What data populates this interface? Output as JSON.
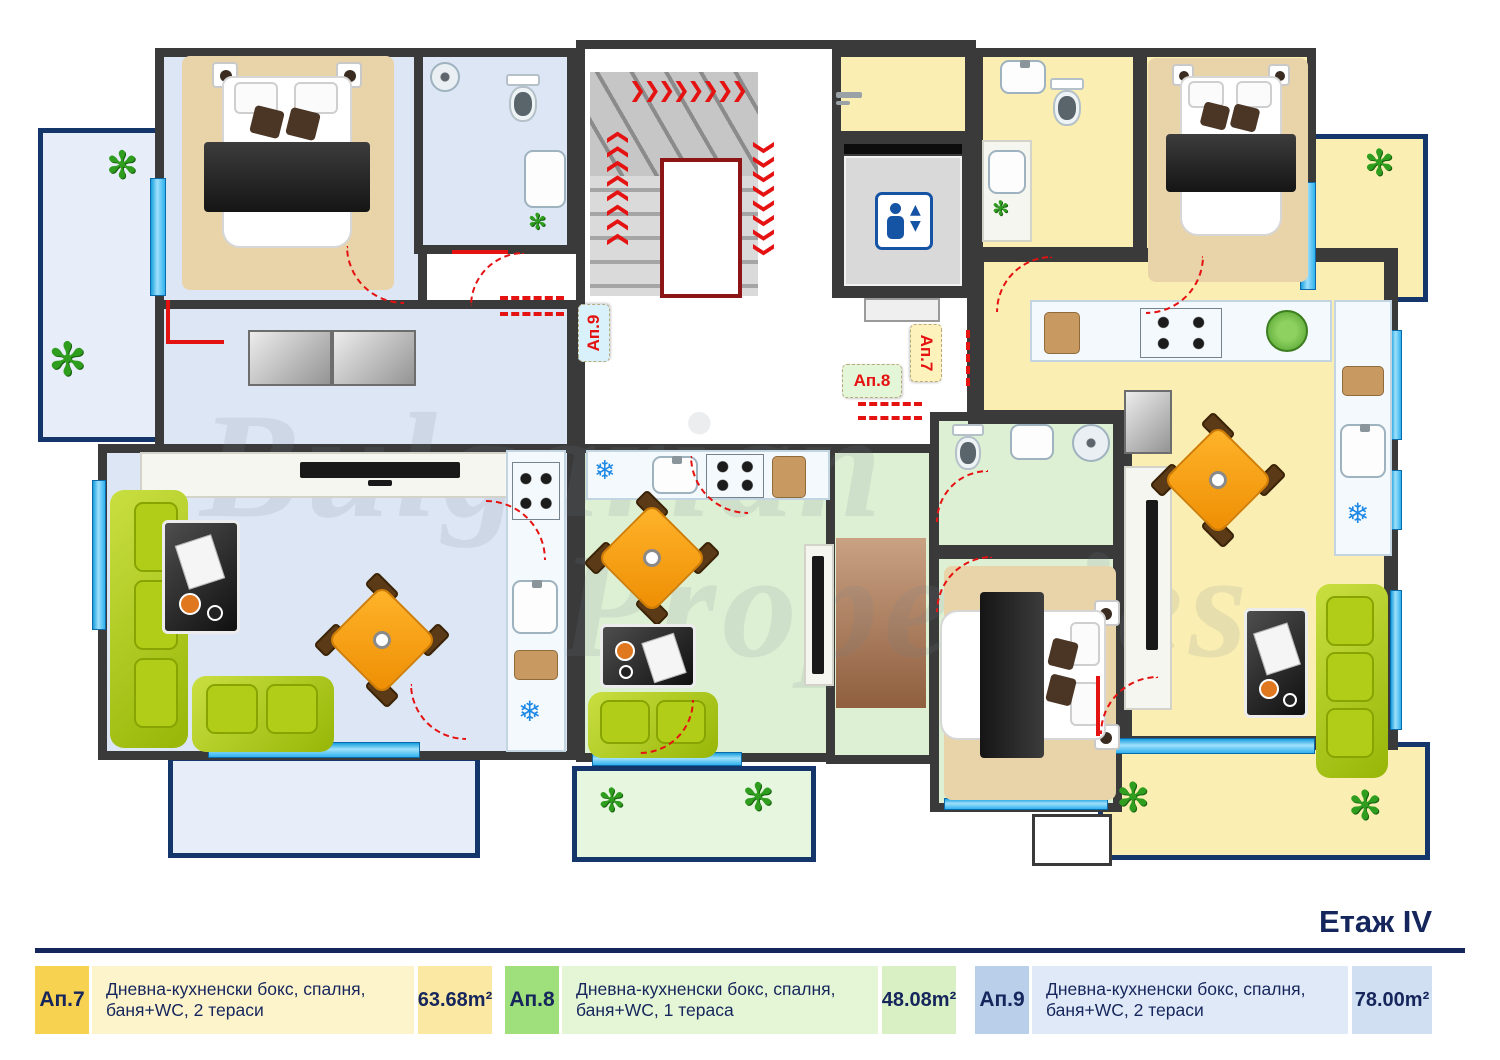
{
  "title": "Етаж IV",
  "watermark": {
    "line1": "Bulgarian",
    "line2": "Properties"
  },
  "plan_tags": {
    "ap9": "Ап.9",
    "ap8": "Ап.8",
    "ap7": "Ап.7"
  },
  "apartments": {
    "ap7": {
      "id": "Ап.7",
      "floor": "#faeeb2",
      "terrace": "#faeeb2",
      "tag_bg": "#fdf1bc"
    },
    "ap8": {
      "id": "Ап.8",
      "floor": "#def0d3",
      "terrace": "#e7f6de",
      "tag_bg": "#e3f6d8"
    },
    "ap9": {
      "id": "Ап.9",
      "floor": "#dce6f5",
      "terrace": "#e8eef9",
      "tag_bg": "#d8f1fb"
    }
  },
  "colors": {
    "wall": "#3a3a3a",
    "terrace_border": "#14366b",
    "door_red": "#e51212",
    "glass_blue": "#2fb2ef",
    "sofa_green": "#abc916",
    "table_orange": "#f59a10",
    "elevator_blue": "#1553a4",
    "navy": "#14265c"
  },
  "icons": {
    "plant": "✻",
    "snowflake": "❄",
    "stairs_arrows": "❯❯❯❯❯❯❯❯",
    "elevator_up": "▲",
    "elevator_down": "▼"
  },
  "legend": [
    {
      "id": "Ап.7",
      "description": "Дневна-кухненски бокс, спалня, баня+WC, 2 тераси",
      "area": "63.68m²",
      "accent": "#f6d250",
      "tint": "#fdf4cc",
      "area_tint": "#fbe8a2"
    },
    {
      "id": "Ап.8",
      "description": "Дневна-кухненски бокс, спалня, баня+WC, 1 тераса",
      "area": "48.08m²",
      "accent": "#9fe07c",
      "tint": "#e5f6d6",
      "area_tint": "#d8f0c4"
    },
    {
      "id": "Ап.9",
      "description": "Дневна-кухненски бокс, спалня, баня+WC, 2 тераси",
      "area": "78.00m²",
      "accent": "#b9cfea",
      "tint": "#dfe9f7",
      "area_tint": "#d0e0f2"
    }
  ]
}
